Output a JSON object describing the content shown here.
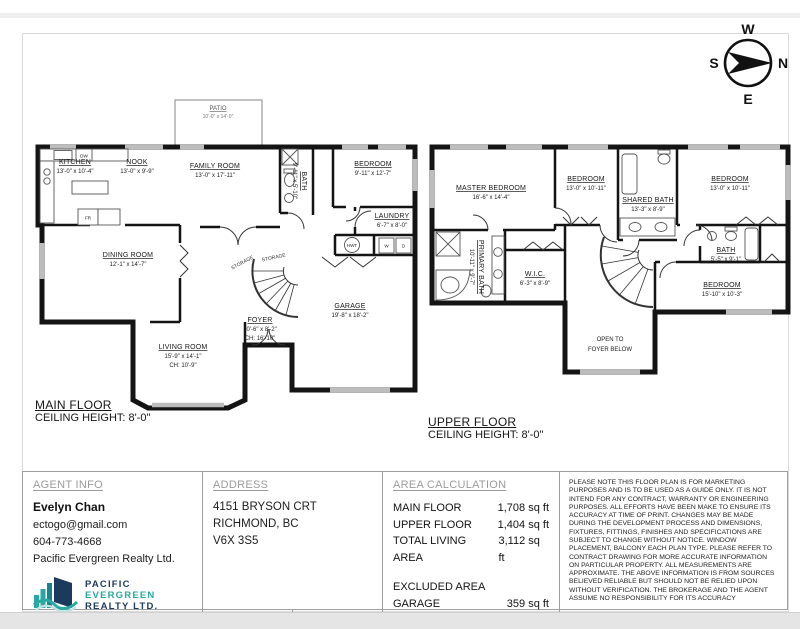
{
  "compass": {
    "w": "W",
    "n": "N",
    "e": "E",
    "s": "S"
  },
  "plans": {
    "main": {
      "title": "MAIN FLOOR",
      "ceiling": "CEILING HEIGHT: 8'-0\"",
      "rooms": {
        "patio": {
          "name": "PATIO",
          "dims": "10'-0\" x 14'-0\""
        },
        "kitchen": {
          "name": "KITCHEN",
          "dims": "13'-0\" x 10'-4\""
        },
        "nook": {
          "name": "NOOK",
          "dims": "13'-0\" x 9'-9\""
        },
        "family": {
          "name": "FAMILY ROOM",
          "dims": "13'-0\" x 17'-11\""
        },
        "bath": {
          "name": "BATH",
          "dims": "9'-11\" x 5'-10\""
        },
        "bedroom": {
          "name": "BEDROOM",
          "dims": "9'-11\" x 12'-7\""
        },
        "laundry": {
          "name": "LAUNDRY",
          "dims": "6'-7\" x 8'-0\""
        },
        "dining": {
          "name": "DINING ROOM",
          "dims": "12'-1\" x 14'-7\""
        },
        "storage": {
          "name": "STORAGE"
        },
        "foyer": {
          "name": "FOYER",
          "dims": "10'-6\" x 8'-2\"",
          "ch": "CH: 16'-10\""
        },
        "garage": {
          "name": "GARAGE",
          "dims": "19'-8\" x 18'-2\""
        },
        "living": {
          "name": "LIVING ROOM",
          "dims": "15'-9\" x 14'-1\"",
          "ch": "CH: 10'-9\""
        }
      },
      "fixtures": {
        "dw": "DW",
        "fr": "FR",
        "hwt": "HWT",
        "w": "W",
        "d": "D"
      }
    },
    "upper": {
      "title": "UPPER FLOOR",
      "ceiling": "CEILING HEIGHT: 8'-0\"",
      "rooms": {
        "master": {
          "name": "MASTER BEDROOM",
          "dims": "16'-6\" x 14'-4\""
        },
        "bedroom_a": {
          "name": "BEDROOM",
          "dims": "13'-0\" x 10'-11\""
        },
        "shared_bath": {
          "name": "SHARED BATH",
          "dims": "13'-3\" x 8'-9\""
        },
        "bedroom_b": {
          "name": "BEDROOM",
          "dims": "13'-0\" x 10'-11\""
        },
        "primary_bath": {
          "name": "PRIMARY BATH",
          "dims": "10'-11\" x 9'-7\""
        },
        "wic": {
          "name": "W.I.C.",
          "dims": "6'-3\" x 8'-9\""
        },
        "bath": {
          "name": "BATH",
          "dims": "5'-5\" x 9'-1\""
        },
        "bedroom_c": {
          "name": "BEDROOM",
          "dims": "15'-10\" x 10'-3\""
        },
        "open": {
          "line1": "OPEN TO",
          "line2": "FOYER BELOW"
        }
      }
    }
  },
  "footer": {
    "agent": {
      "header": "AGENT INFO",
      "name": "Evelyn Chan",
      "email": "ectogo@gmail.com",
      "phone": "604-773-4668",
      "company": "Pacific Evergreen Realty Ltd.",
      "logo": {
        "line1": "PACIFIC",
        "line2": "EVERGREEN",
        "line3": "REALTY LTD."
      }
    },
    "address": {
      "header": "ADDRESS",
      "line1": "4151 BRYSON CRT",
      "line2": "RICHMOND, BC",
      "line3": "V6X 3S5",
      "date_label": "DATE",
      "date_value": "11/01/2026",
      "scale_label": "SCALE",
      "scale_value": "N.T.S."
    },
    "area": {
      "header": "AREA CALCULATION",
      "rows": [
        {
          "label": "MAIN FLOOR",
          "value": "1,708 sq ft"
        },
        {
          "label": "UPPER FLOOR",
          "value": "1,404 sq ft"
        },
        {
          "label": "TOTAL LIVING AREA",
          "value": "3,112 sq ft"
        },
        {
          "label": "EXCLUDED AREA",
          "value": ""
        },
        {
          "label": "GARAGE",
          "value": "359 sq ft"
        },
        {
          "label": "PATIO",
          "value": "140 sq ft"
        }
      ]
    },
    "disclaimer": "PLEASE NOTE THIS FLOOR PLAN IS FOR MARKETING PURPOSES AND IS TO BE USED AS A GUIDE ONLY. IT IS NOT INTEND FOR ANY CONTRACT, WARRANTY OR ENGINEERING PURPOSES. ALL EFFORTS HAVE BEEN MAKE TO ENSURE ITS ACCURACY AT TIME OF PRINT. CHANGES MAY BE MADE DURING THE DEVELOPMENT PROCESS AND DIMENSIONS, FIXTURES, FITTINGS, FINISHES AND SPECIFICATIONS ARE SUBJECT TO CHANGE WITHOUT NOTICE. WINDOW PLACEMENT, BALCONY EACH PLAN TYPE. PLEASE REFER TO CONTRACT DRAWING FOR MORE ACCURATE INFORMATION ON PARTICULAR PROPERTY. ALL MEASUREMENTS ARE APPROXIMATE. THE ABOVE INFORMATION IS FROM SOURCES BELIEVED RELIABLE BUT SHOULD NOT BE RELIED UPON WITHOUT VERIFICATION. THE BROKERAGE AND THE AGENT ASSUME NO RESPONSIBILITY FOR ITS ACCURACY"
  },
  "colors": {
    "navy": "#1c3a5e",
    "teal": "#2aa8a2"
  }
}
